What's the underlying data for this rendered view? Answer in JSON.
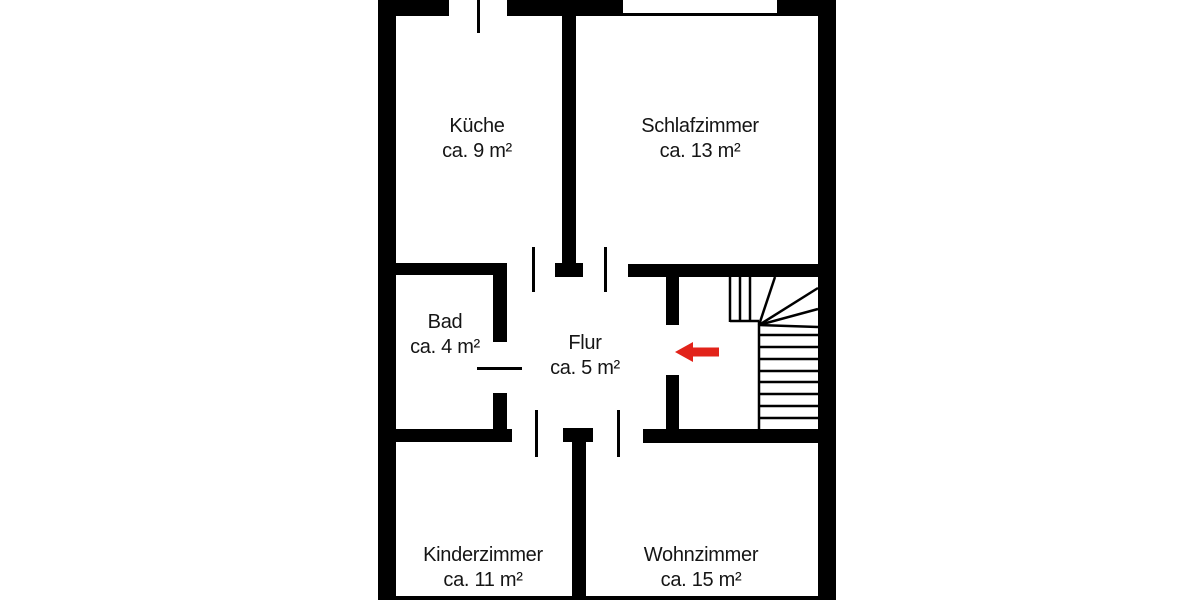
{
  "plan": {
    "type": "apartment-floor-plan",
    "language": "de"
  },
  "colors": {
    "background": "#ffffff",
    "wall": "#000000",
    "text": "#151515",
    "arrow_red": "#e2231a"
  },
  "rooms": [
    {
      "name": "Küche",
      "area": "ca. 9 m²"
    },
    {
      "name": "Schlafzimmer",
      "area": "ca. 13 m²"
    },
    {
      "name": "Bad",
      "area": "ca. 4 m²"
    },
    {
      "name": "Flur",
      "area": "ca. 5 m²"
    },
    {
      "name": "Kinderzimmer",
      "area": "ca. 11 m²"
    },
    {
      "name": "Wohnzimmer",
      "area": "ca. 15 m²"
    }
  ],
  "symbols": {
    "window": "window-in-top-wall",
    "stairs": "quarter-turn-winder-staircase",
    "arrow": "entrance-direction-arrow-pointing-left",
    "doors": [
      "kueche-exterior-door",
      "bad-door",
      "flur-kueche-opening",
      "flur-schlafzimmer-opening",
      "flur-kinderzimmer-opening",
      "flur-wohnzimmer-opening",
      "flur-staircase-opening"
    ]
  }
}
